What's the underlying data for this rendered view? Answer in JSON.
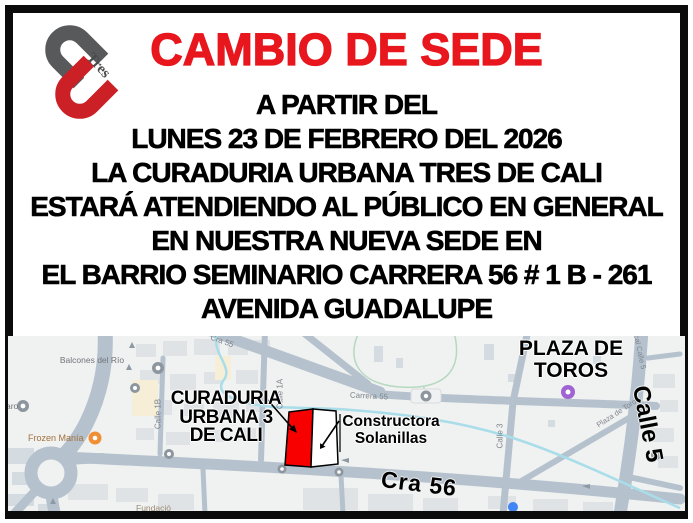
{
  "poster": {
    "title": "CAMBIO DE SEDE",
    "lines": [
      "A PARTIR DEL",
      "LUNES 23 DE FEBRERO DEL 2026",
      "LA CURADURIA URBANA TRES DE CALI",
      "ESTARÁ ATENDIENDO AL PÚBLICO EN GENERAL",
      "EN NUESTRA NUEVA SEDE EN",
      "EL BARRIO SEMINARIO CARRERA 56 # 1 B - 261",
      "AVENIDA GUADALUPE"
    ],
    "logo": {
      "text": "Tres"
    },
    "colors": {
      "title_red": "#e8161d",
      "logo_gray": "#58595b",
      "logo_red": "#cb2026",
      "border_black": "#0b0b0b"
    }
  },
  "map": {
    "annotations": {
      "curaduria_line1": "CURADURIA",
      "curaduria_line2": "URBANA 3",
      "curaduria_line3": "DE CALI",
      "constructora_line1": "Constructora",
      "constructora_line2": "Solanillas",
      "plaza_line1": "PLAZA DE",
      "plaza_line2": "TOROS",
      "cra56": "Cra 56",
      "calle5": "Calle 5"
    },
    "street_labels": {
      "carrera55": "Carrera 55",
      "cra55_diagonal": "Cra 55",
      "calle3": "Calle 3",
      "calle1a": "Calle 1A",
      "calle1b": "Calle 1B",
      "calle5_small": "cal Calle 5",
      "plaza_small": "Plaza de Toros"
    },
    "poi": {
      "balcones": "Balcones del Río",
      "aro_partial": "aro",
      "frozen": "Frozen Manía",
      "fundacio_partial": "Fundació"
    },
    "colors": {
      "background": "#f0f1f1",
      "road": "#b5c2ce",
      "water": "#a8dde9",
      "park_line": "#b5d9bf",
      "building": "#e0e3e6",
      "building_cream": "#f6eed6",
      "highlight_red": "#f80000",
      "marker_orange": "#ef9037",
      "marker_purple": "#9f63d2",
      "marker_blue": "#4285f4"
    }
  }
}
